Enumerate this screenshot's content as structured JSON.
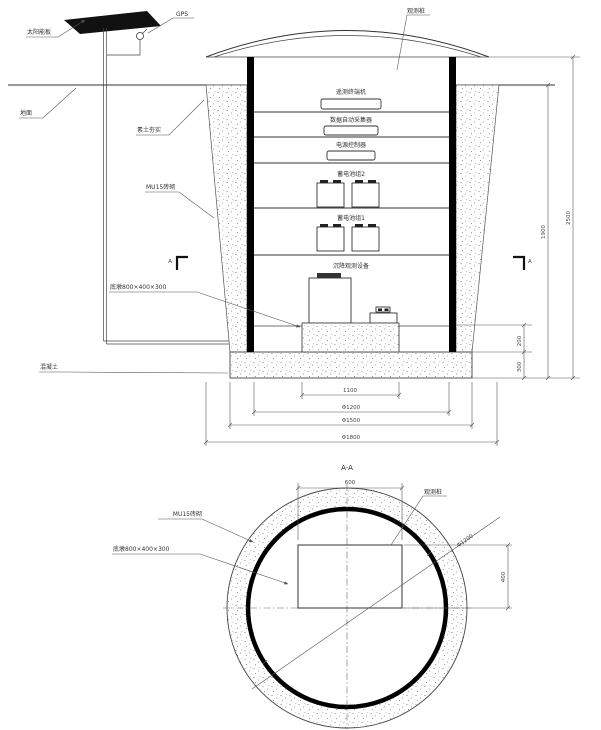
{
  "drawing": {
    "section": {
      "callouts": {
        "solar_panel": "太阳能板",
        "gps": "GPS",
        "observation_post": "观测桩",
        "ground": "地面",
        "compacted_soil": "素土夯实",
        "brick_masonry": "MU15砖砌",
        "pedestal": "底墩800×400×300",
        "concrete": "混凝土"
      },
      "equipment": {
        "telemetry_terminal": "遥测终端机",
        "data_collector": "数据自动采集器",
        "power_controller": "电源控制器",
        "battery_group_2": "蓄电池组2",
        "battery_group_1": "蓄电池组1",
        "observation_instrument": "沉降观测设备"
      },
      "dimensions": {
        "width_inner": "1100",
        "dia_1200": "Φ1200",
        "dia_1500": "Φ1500",
        "dia_1800": "Φ1800",
        "height_inner": "1900",
        "height_total": "2500",
        "pedestal_height": "200",
        "slab_thickness": "300"
      },
      "section_marker": "A"
    },
    "plan": {
      "title": "A-A",
      "callouts": {
        "brick_masonry": "MU15砖砌",
        "pedestal": "底墩800×400×300",
        "observation_post": "观测桩",
        "inner_diameter": "Φ1200"
      },
      "dimensions": {
        "pedestal_width": "600",
        "pedestal_depth": "400"
      }
    }
  }
}
